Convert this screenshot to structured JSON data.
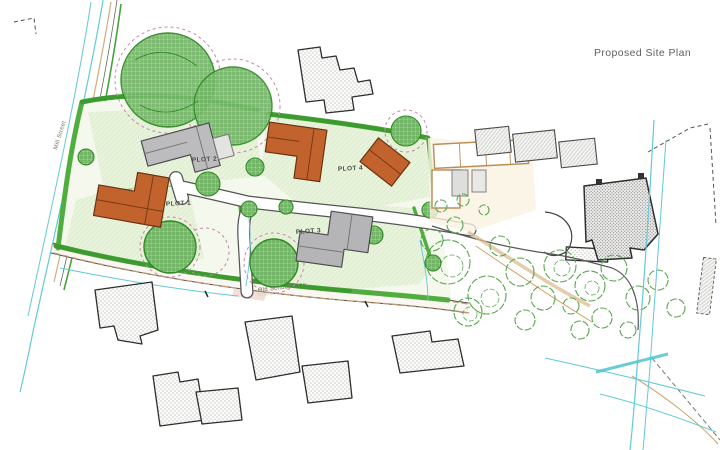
{
  "title": "Proposed Site Plan",
  "plan": {
    "plots": [
      {
        "id": "plot-1",
        "label": "PLOT 1"
      },
      {
        "id": "plot-2",
        "label": "PLOT 2"
      },
      {
        "id": "plot-3",
        "label": "PLOT 3"
      },
      {
        "id": "plot-4",
        "label": "PLOT 4"
      }
    ],
    "roads": [
      {
        "id": "old-school-lane",
        "label": "Old School Lane"
      },
      {
        "id": "mill-street",
        "label": "Mill Street"
      }
    ],
    "colors": {
      "proposed_roof_orange": "#c2632e",
      "proposed_roof_grey": "#b5b5b7",
      "hedge_green": "#4fae3d",
      "tree_outline_green": "#5aa64e",
      "garden_fill": "#e9f3dc",
      "water_cyan": "#62c9d6",
      "rpa_dashed_pink": "#c489ae",
      "existing_building_outline": "#2e2e2e",
      "lane_edge_tan": "#c49a6c",
      "title_grey": "#5f5f5f"
    }
  }
}
